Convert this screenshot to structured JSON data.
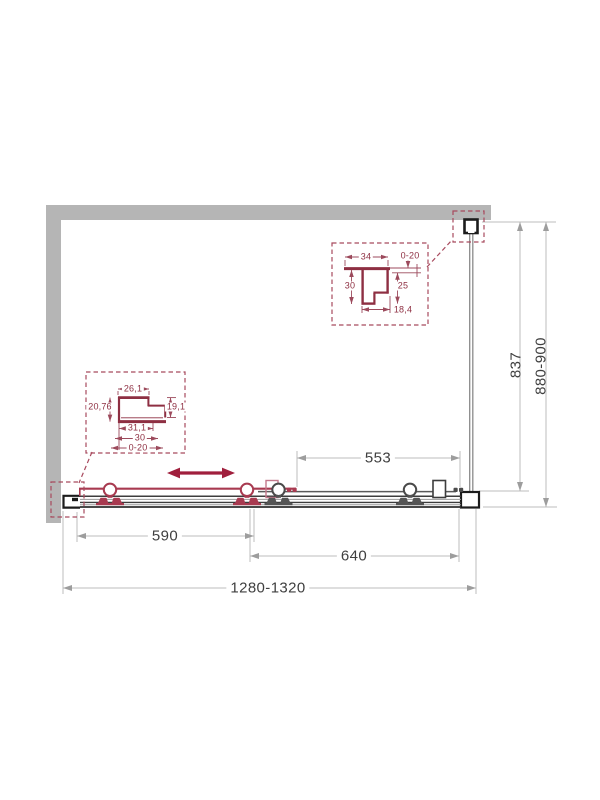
{
  "drawing": {
    "title": "shower-enclosure-plan-technical-drawing",
    "dimensions": {
      "front_total": "1280-1320",
      "door_width": "590",
      "opening_width": "640",
      "fixed_front": "553",
      "side_total": "880-900",
      "side_glass": "837"
    },
    "top_profile_detail": {
      "width": "34",
      "gap": "0-20",
      "depth": "30",
      "inner_depth": "25",
      "bottom_width": "18,4"
    },
    "bottom_profile_detail": {
      "top_width": "26,1",
      "left_height": "20,76",
      "right_height": "19,1",
      "width_1": "31,1",
      "width_2": "30",
      "gap": "0-20"
    },
    "colors": {
      "accent_red": "#a83a50",
      "detail_maroon": "#8e2f42",
      "wall_gray": "#b5b5b5",
      "line_gray": "#bdbdbd",
      "text_dark": "#3f3f3f"
    }
  }
}
